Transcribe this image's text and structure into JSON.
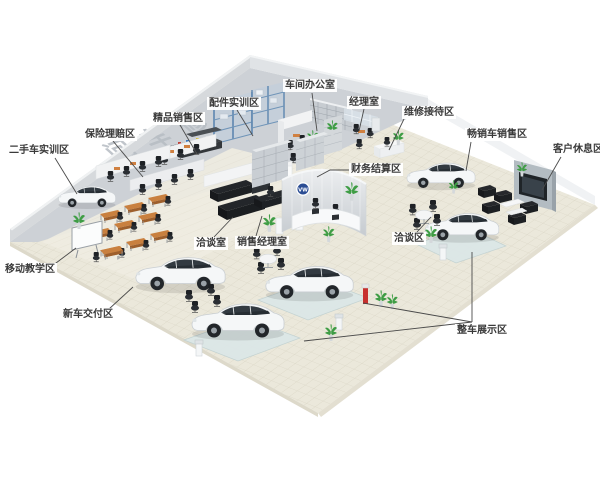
{
  "scene": {
    "floor_chars": [
      "修",
      "车",
      "间"
    ],
    "colors": {
      "background": "#ffffff",
      "workshop_floor": "#cdd1d6",
      "showroom_floor": "#ebe8db",
      "tile_line": "#d9d5c4",
      "wall": "#d6d9dc",
      "wall_top": "#eef0f2",
      "label_text": "#3a3a3a",
      "leader_line": "#4a4a4a",
      "rack_blue": "#5d86b0",
      "desk_orange": "#c9803f",
      "furniture_black": "#26282c",
      "plant_green": "#3f9d45",
      "car_white": "#f5f7f8",
      "platform_glass": "#dce7e7",
      "vw_logo_blue": "#2b4d94",
      "extinguisher_red": "#c8302e"
    }
  },
  "labels": [
    {
      "id": "workshop-office",
      "text": "车间办公室",
      "x": 283,
      "y": 79,
      "leaders": [
        [
          [
            312,
            93
          ],
          [
            317,
            131
          ]
        ]
      ]
    },
    {
      "id": "manager-room",
      "text": "经理室",
      "x": 347,
      "y": 96,
      "leaders": [
        [
          [
            364,
            109
          ],
          [
            359,
            131
          ]
        ]
      ]
    },
    {
      "id": "maintenance-reception",
      "text": "维修接待区",
      "x": 402,
      "y": 106,
      "leaders": [
        [
          [
            404,
            119
          ],
          [
            389,
            150
          ]
        ]
      ]
    },
    {
      "id": "parts-training",
      "text": "配件实训区",
      "x": 207,
      "y": 97,
      "leaders": [
        [
          [
            237,
            110
          ],
          [
            253,
            136
          ]
        ]
      ]
    },
    {
      "id": "boutique-sales",
      "text": "精品销售区",
      "x": 151,
      "y": 112,
      "leaders": [
        [
          [
            180,
            125
          ],
          [
            197,
            154
          ]
        ]
      ]
    },
    {
      "id": "insurance-claims",
      "text": "保险理赔区",
      "x": 83,
      "y": 128,
      "leaders": [
        [
          [
            113,
            141
          ],
          [
            143,
            177
          ]
        ]
      ]
    },
    {
      "id": "used-car-training",
      "text": "二手车实训区",
      "x": 7,
      "y": 144,
      "leaders": [
        [
          [
            55,
            158
          ],
          [
            77,
            194
          ]
        ]
      ]
    },
    {
      "id": "hot-car-sales",
      "text": "畅销车销售区",
      "x": 465,
      "y": 128,
      "leaders": [
        [
          [
            471,
            142
          ],
          [
            466,
            171
          ]
        ]
      ]
    },
    {
      "id": "customer-rest",
      "text": "客户休息区",
      "x": 551,
      "y": 143,
      "leaders": [
        [
          [
            561,
            157
          ],
          [
            542,
            190
          ]
        ]
      ]
    },
    {
      "id": "finance-settlement",
      "text": "财务结算区",
      "x": 349,
      "y": 163,
      "leaders": [
        [
          [
            349,
            170
          ],
          [
            330,
            170
          ],
          [
            317,
            177
          ]
        ]
      ]
    },
    {
      "id": "negotiation-room",
      "text": "洽谈室",
      "x": 194,
      "y": 237,
      "leaders": [
        [
          [
            214,
            237
          ],
          [
            233,
            217
          ]
        ]
      ]
    },
    {
      "id": "sales-manager-room",
      "text": "销售经理室",
      "x": 235,
      "y": 236,
      "leaders": [
        [
          [
            256,
            236
          ],
          [
            262,
            216
          ]
        ]
      ]
    },
    {
      "id": "negotiation-area",
      "text": "洽谈区",
      "x": 392,
      "y": 232,
      "leaders": [
        [
          [
            417,
            232
          ],
          [
            431,
            217
          ]
        ]
      ]
    },
    {
      "id": "mobile-teaching",
      "text": "移动教学区",
      "x": 3,
      "y": 263,
      "leaders": [
        [
          [
            52,
            266
          ],
          [
            76,
            248
          ]
        ]
      ]
    },
    {
      "id": "new-car-delivery",
      "text": "新车交付区",
      "x": 61,
      "y": 308,
      "leaders": [
        [
          [
            109,
            309
          ],
          [
            133,
            287
          ]
        ]
      ]
    },
    {
      "id": "vehicle-display",
      "text": "整车展示区",
      "x": 455,
      "y": 324,
      "leaders": [
        [
          [
            472,
            252
          ],
          [
            472,
            322
          ]
        ],
        [
          [
            363,
            303
          ],
          [
            472,
            322
          ]
        ],
        [
          [
            304,
            341
          ],
          [
            472,
            322
          ]
        ]
      ]
    }
  ]
}
